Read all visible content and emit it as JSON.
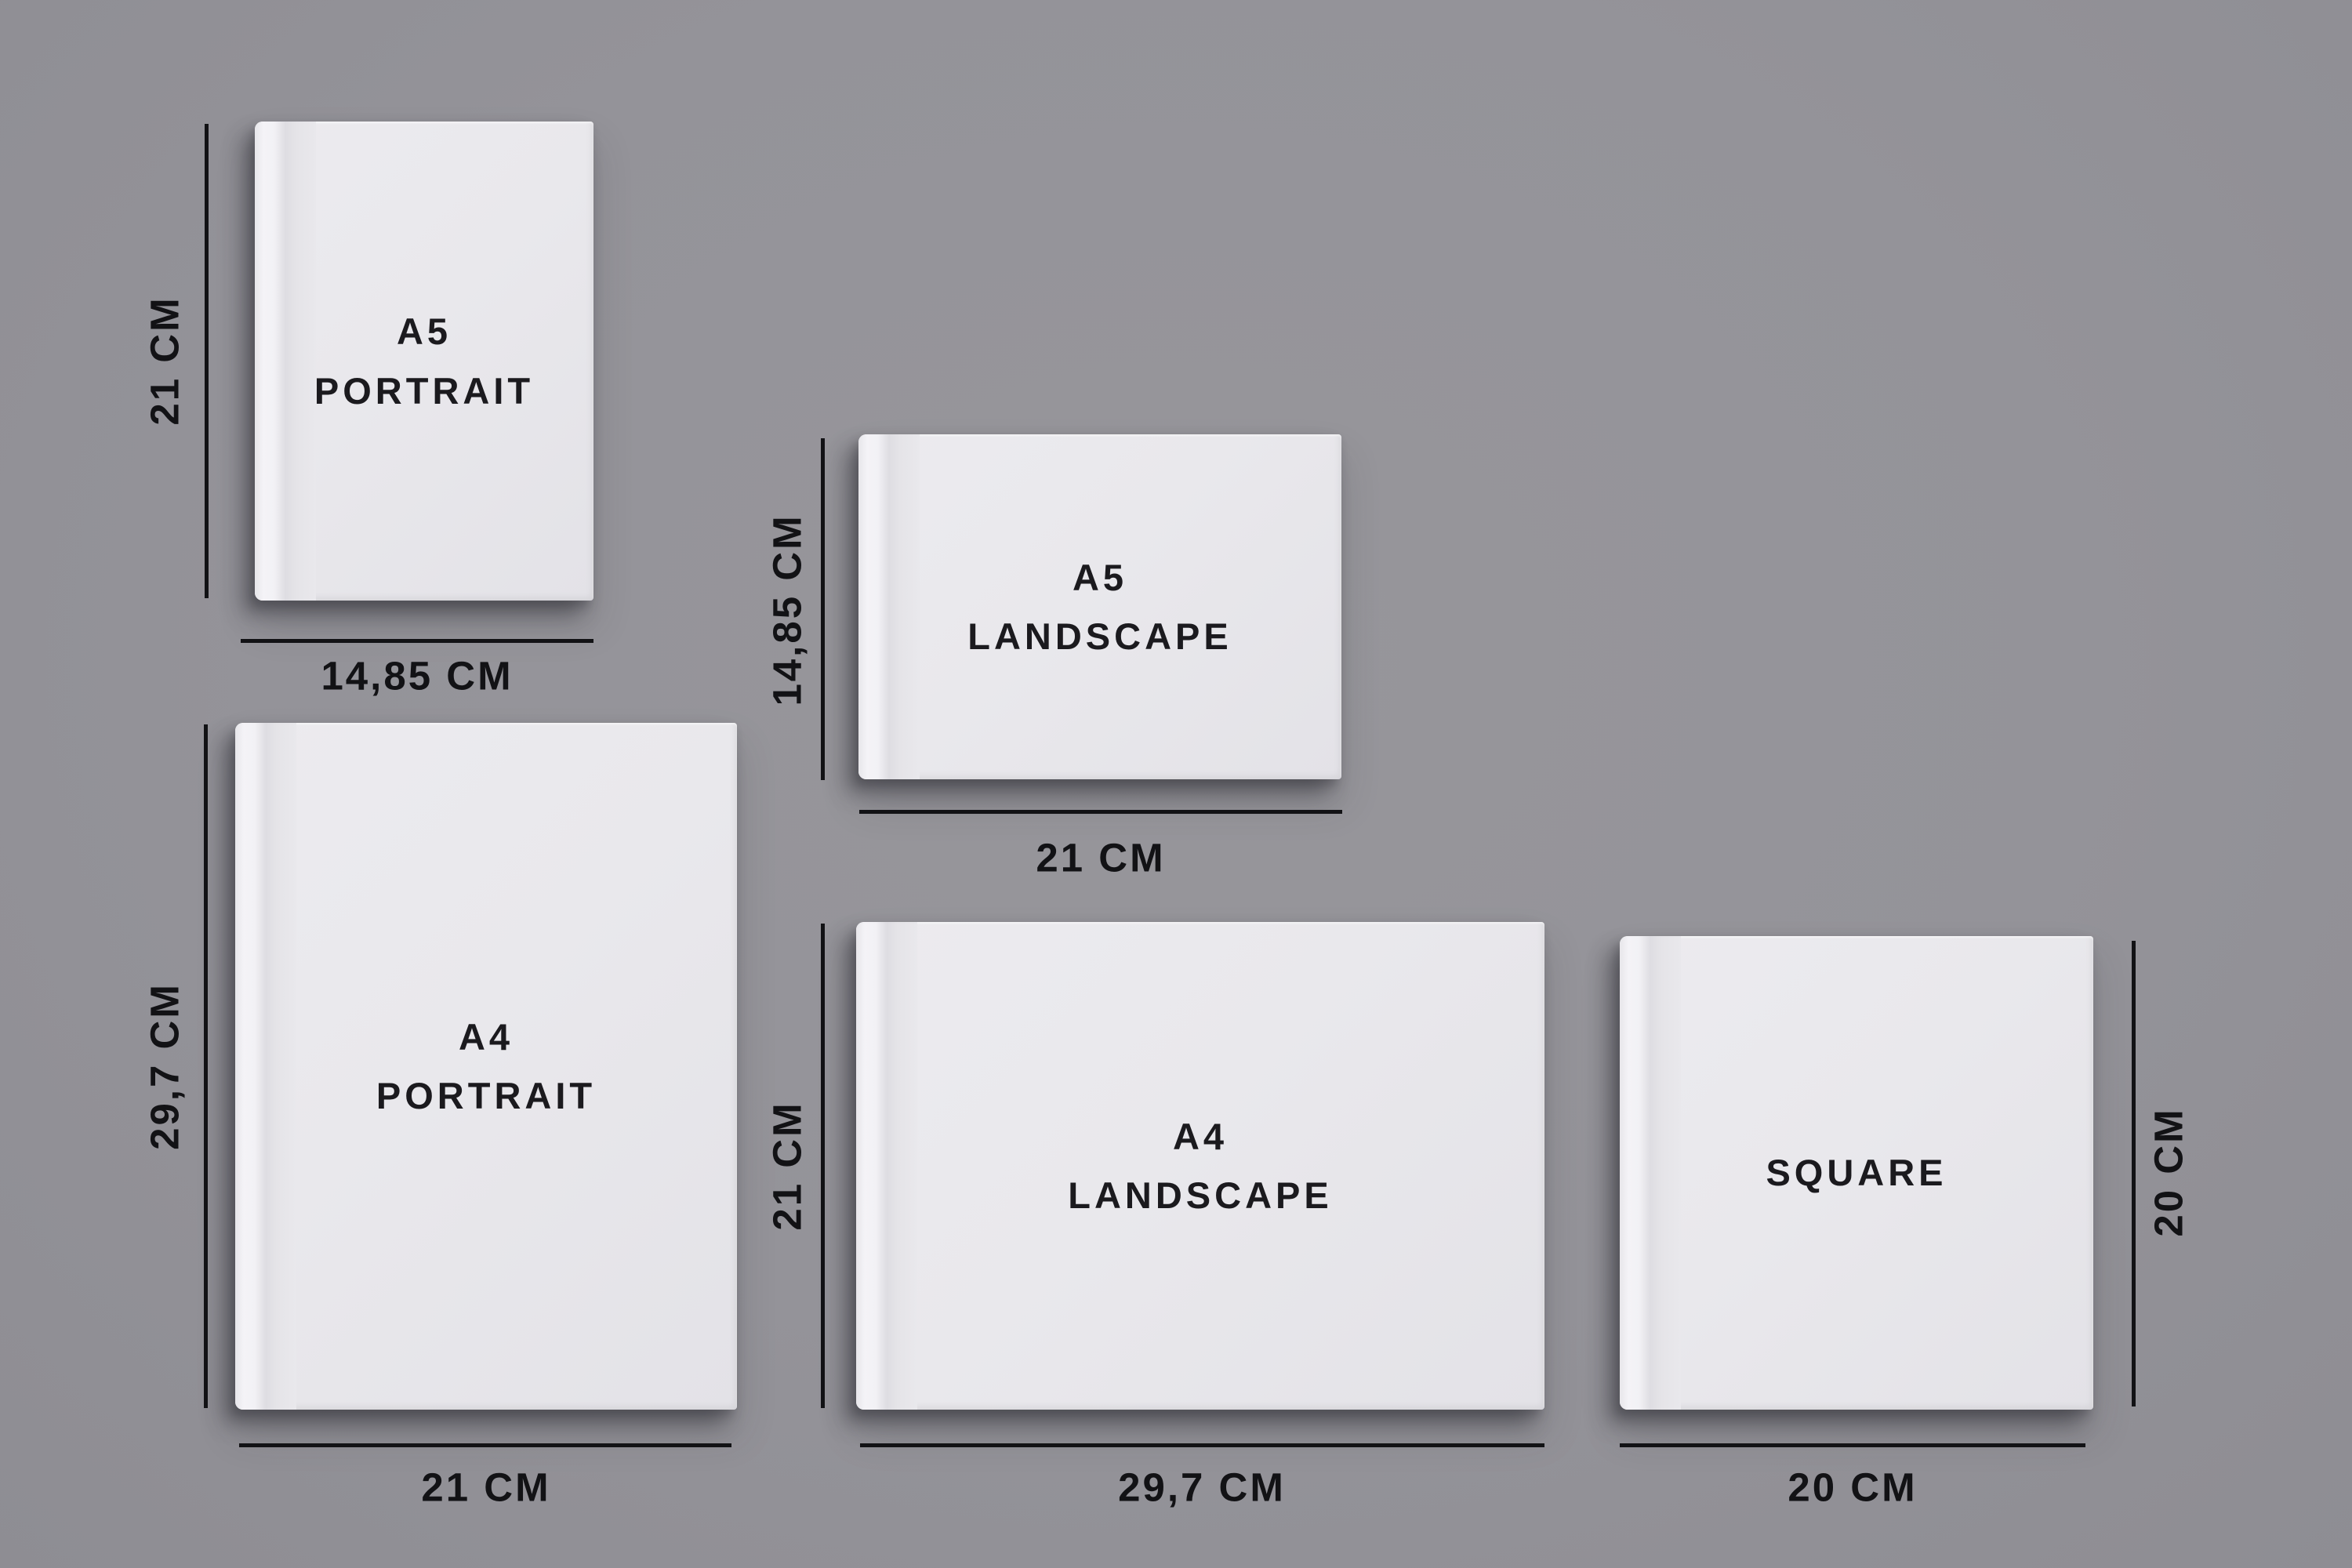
{
  "page": {
    "description": "Photo book size comparison diagram",
    "background_color": "#949399",
    "line_color": "#121215",
    "cover_color": "#e8e7ea",
    "text_color": "#1b1a1e",
    "units": "CM"
  },
  "books": [
    {
      "id": "a5-portrait",
      "title": "A5\nPORTRAIT",
      "height_label": "21 CM",
      "width_label": "14,85 CM",
      "width_cm": 14.85,
      "height_cm": 21,
      "dimension_side": "left"
    },
    {
      "id": "a5-landscape",
      "title": "A5\nLANDSCAPE",
      "height_label": "14,85 CM",
      "width_label": "21 CM",
      "width_cm": 21,
      "height_cm": 14.85,
      "dimension_side": "left"
    },
    {
      "id": "a4-portrait",
      "title": "A4\nPORTRAIT",
      "height_label": "29,7 CM",
      "width_label": "21 CM",
      "width_cm": 21,
      "height_cm": 29.7,
      "dimension_side": "left"
    },
    {
      "id": "a4-landscape",
      "title": "A4\nLANDSCAPE",
      "height_label": "21 CM",
      "width_label": "29,7 CM",
      "width_cm": 29.7,
      "height_cm": 21,
      "dimension_side": "left"
    },
    {
      "id": "square",
      "title": "SQUARE",
      "height_label": "20 CM",
      "width_label": "20 CM",
      "width_cm": 20,
      "height_cm": 20,
      "dimension_side": "right"
    }
  ]
}
